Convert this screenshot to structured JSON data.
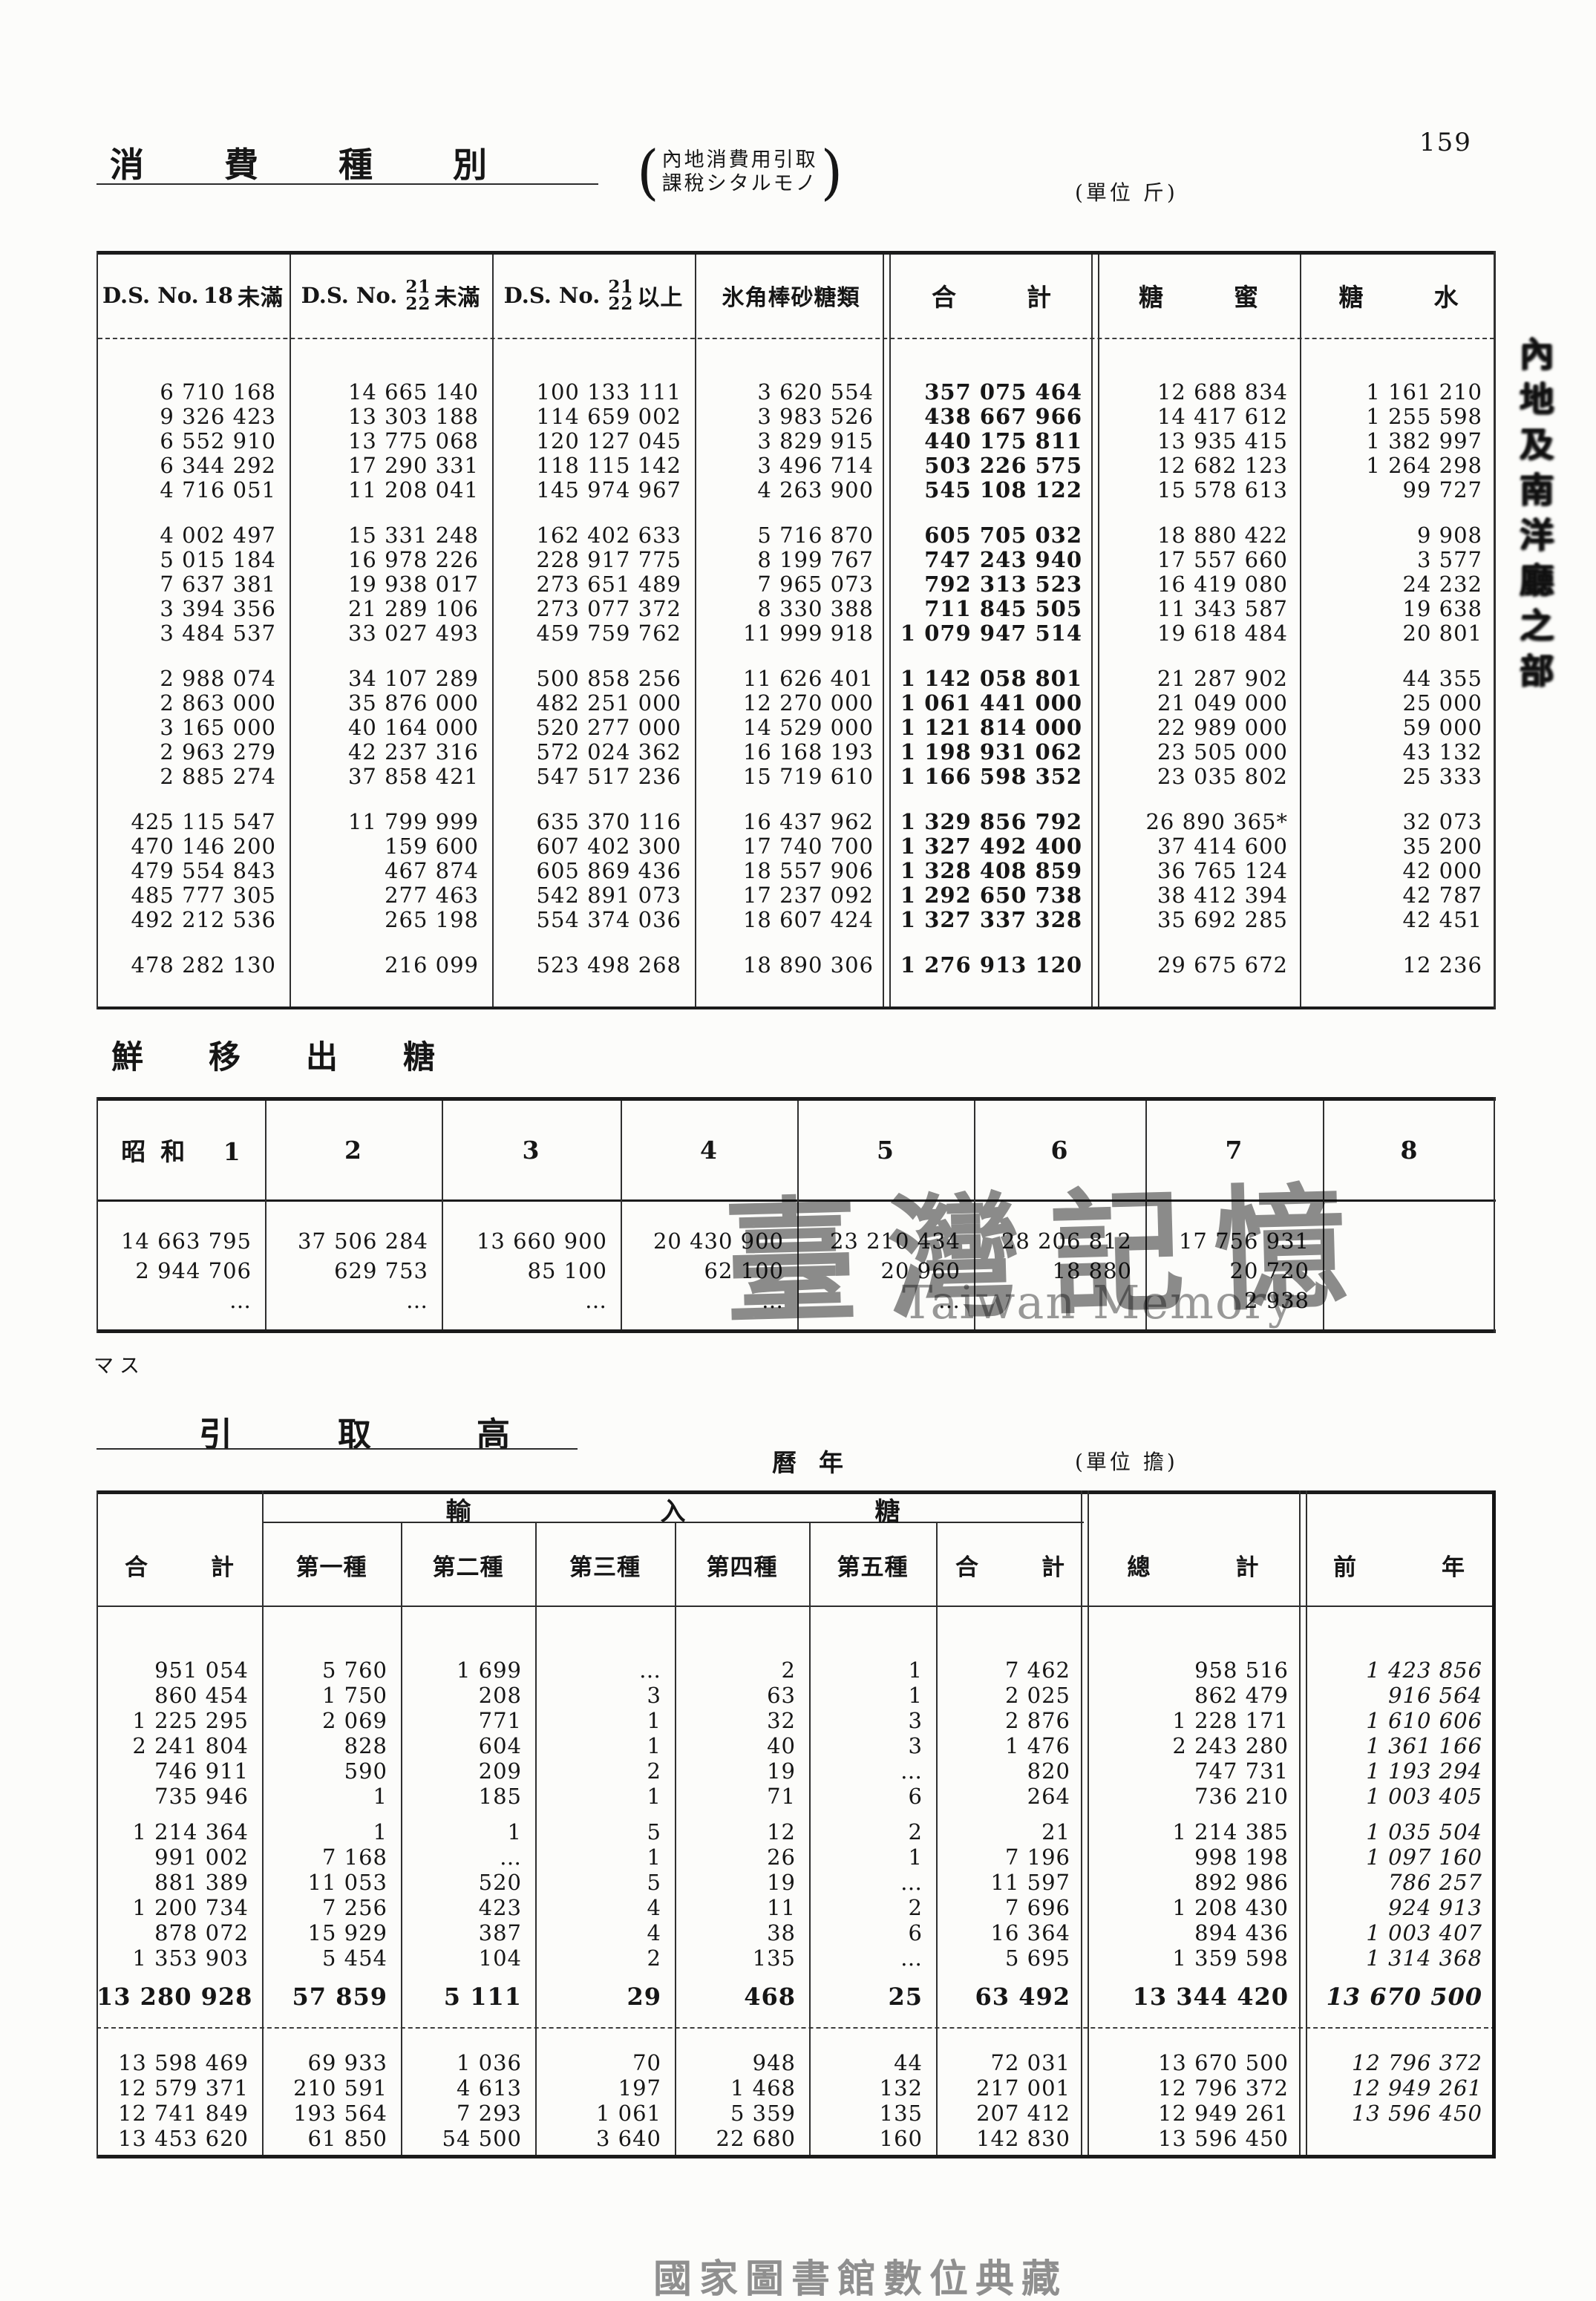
{
  "page": {
    "number": "159",
    "footer": "國家圖書館數位典藏",
    "margin_note": "マス",
    "side_text": "內地及南洋廳之部"
  },
  "watermark": {
    "cjk": "臺灣記憶",
    "latin": "Taiwan Memory"
  },
  "header": {
    "title": "消費種別",
    "annotation_line1": "內地消費用引取",
    "annotation_line2": "課稅シタルモノ",
    "paren_open": "(",
    "paren_close": ")",
    "unit": "(單位 斤)"
  },
  "consumption_table": {
    "headers": {
      "h1": {
        "prefix": "D.S. No.",
        "value": "18",
        "suffix": "未滿"
      },
      "h2": {
        "prefix": "D.S. No.",
        "num": "21",
        "den": "22",
        "suffix": "未滿"
      },
      "h3": {
        "prefix": "D.S. No.",
        "num": "21",
        "den": "22",
        "suffix": "以上"
      },
      "h4": "氷角棒砂糖類",
      "h5": "合計",
      "h6": "糖蜜",
      "h7": "糖水"
    },
    "groups": [
      [
        [
          "6 710 168",
          "14 665 140",
          "100 133 111",
          "3 620 554",
          "357 075 464",
          "12 688 834",
          "1 161 210"
        ],
        [
          "9 326 423",
          "13 303 188",
          "114 659 002",
          "3 983 526",
          "438 667 966",
          "14 417 612",
          "1 255 598"
        ],
        [
          "6 552 910",
          "13 775 068",
          "120 127 045",
          "3 829 915",
          "440 175 811",
          "13 935 415",
          "1 382 997"
        ],
        [
          "6 344 292",
          "17 290 331",
          "118 115 142",
          "3 496 714",
          "503 226 575",
          "12 682 123",
          "1 264 298"
        ],
        [
          "4 716 051",
          "11 208 041",
          "145 974 967",
          "4 263 900",
          "545 108 122",
          "15 578 613",
          "99 727"
        ]
      ],
      [
        [
          "4 002 497",
          "15 331 248",
          "162 402 633",
          "5 716 870",
          "605 705 032",
          "18 880 422",
          "9 908"
        ],
        [
          "5 015 184",
          "16 978 226",
          "228 917 775",
          "8 199 767",
          "747 243 940",
          "17 557 660",
          "3 577"
        ],
        [
          "7 637 381",
          "19 938 017",
          "273 651 489",
          "7 965 073",
          "792 313 523",
          "16 419 080",
          "24 232"
        ],
        [
          "3 394 356",
          "21 289 106",
          "273 077 372",
          "8 330 388",
          "711 845 505",
          "11 343 587",
          "19 638"
        ],
        [
          "3 484 537",
          "33 027 493",
          "459 759 762",
          "11 999 918",
          "1 079 947 514",
          "19 618 484",
          "20 801"
        ]
      ],
      [
        [
          "2 988 074",
          "34 107 289",
          "500 858 256",
          "11 626 401",
          "1 142 058 801",
          "21 287 902",
          "44 355"
        ],
        [
          "2 863 000",
          "35 876 000",
          "482 251 000",
          "12 270 000",
          "1 061 441 000",
          "21 049 000",
          "25 000"
        ],
        [
          "3 165 000",
          "40 164 000",
          "520 277 000",
          "14 529 000",
          "1 121 814 000",
          "22 989 000",
          "59 000"
        ],
        [
          "2 963 279",
          "42 237 316",
          "572 024 362",
          "16 168 193",
          "1 198 931 062",
          "23 505 000",
          "43 132"
        ],
        [
          "2 885 274",
          "37 858 421",
          "547 517 236",
          "15 719 610",
          "1 166 598 352",
          "23 035 802",
          "25 333"
        ]
      ],
      [
        [
          "425 115 547",
          "11 799 999",
          "635 370 116",
          "16 437 962",
          "1 329 856 792",
          "26 890 365*",
          "32 073"
        ],
        [
          "470 146 200",
          "159 600",
          "607 402 300",
          "17 740 700",
          "1 327 492 400",
          "37 414 600",
          "35 200"
        ],
        [
          "479 554 843",
          "467 874",
          "605 869 436",
          "18 557 906",
          "1 328 408 859",
          "36 765 124",
          "42 000"
        ],
        [
          "485 777 305",
          "277 463",
          "542 891 073",
          "17 237 092",
          "1 292 650 738",
          "38 412 394",
          "42 787"
        ],
        [
          "492 212 536",
          "265 198",
          "554 374 036",
          "18 607 424",
          "1 327 337 328",
          "35 692 285",
          "42 451"
        ]
      ],
      [
        [
          "478 282 130",
          "216 099",
          "523 498 268",
          "18 890 306",
          "1 276 913 120",
          "29 675 672",
          "12 236"
        ]
      ]
    ]
  },
  "export_section": {
    "title": "鮮移出糖",
    "headers": [
      "昭和 1",
      "2",
      "3",
      "4",
      "5",
      "6",
      "7",
      "8"
    ],
    "groups": [
      [
        [
          "14 663 795",
          "37 506 284",
          "13 660 900",
          "20 430 900",
          "23 210 434",
          "28 206 812",
          "17 756 931",
          ""
        ],
        [
          "2 944 706",
          "629 753",
          "85 100",
          "62 100",
          "20 960",
          "18 880",
          "20 720",
          ""
        ],
        [
          "…",
          "…",
          "…",
          "…",
          "…",
          "",
          "2 938",
          ""
        ]
      ]
    ]
  },
  "intake_section": {
    "title": "引取高",
    "calendar_label": "曆年",
    "unit": "(單位 擔)",
    "span_header": "輸入糖",
    "columns": [
      "合計",
      "第一種",
      "第二種",
      "第三種",
      "第四種",
      "第五種",
      "合計",
      "總計",
      "前年"
    ],
    "groups": [
      [
        [
          "951 054",
          "5 760",
          "1 699",
          "…",
          "2",
          "1",
          "7 462",
          "958 516",
          "1 423 856"
        ],
        [
          "860 454",
          "1 750",
          "208",
          "3",
          "63",
          "1",
          "2 025",
          "862 479",
          "916 564"
        ],
        [
          "1 225 295",
          "2 069",
          "771",
          "1",
          "32",
          "3",
          "2 876",
          "1 228 171",
          "1 610 606"
        ],
        [
          "2 241 804",
          "828",
          "604",
          "1",
          "40",
          "3",
          "1 476",
          "2 243 280",
          "1 361 166"
        ],
        [
          "746 911",
          "590",
          "209",
          "2",
          "19",
          "…",
          "820",
          "747 731",
          "1 193 294"
        ],
        [
          "735 946",
          "1",
          "185",
          "1",
          "71",
          "6",
          "264",
          "736 210",
          "1 003 405"
        ]
      ],
      [
        [
          "1 214 364",
          "1",
          "1",
          "5",
          "12",
          "2",
          "21",
          "1 214 385",
          "1 035 504"
        ],
        [
          "991 002",
          "7 168",
          "…",
          "1",
          "26",
          "1",
          "7 196",
          "998 198",
          "1 097 160"
        ],
        [
          "881 389",
          "11 053",
          "520",
          "5",
          "19",
          "…",
          "11 597",
          "892 986",
          "786 257"
        ],
        [
          "1 200 734",
          "7 256",
          "423",
          "4",
          "11",
          "2",
          "7 696",
          "1 208 430",
          "924 913"
        ],
        [
          "878 072",
          "15 929",
          "387",
          "4",
          "38",
          "6",
          "16 364",
          "894 436",
          "1 003 407"
        ],
        [
          "1 353 903",
          "5 454",
          "104",
          "2",
          "135",
          "…",
          "5 695",
          "1 359 598",
          "1 314 368"
        ]
      ]
    ],
    "totals": [
      [
        [
          "13 280 928",
          "57 859",
          "5 111",
          "29",
          "468",
          "25",
          "63 492",
          "13 344 420",
          "13 670 500"
        ]
      ]
    ],
    "final": [
      [
        [
          "13 598 469",
          "69 933",
          "1 036",
          "70",
          "948",
          "44",
          "72 031",
          "13 670 500",
          "12 796 372"
        ],
        [
          "12 579 371",
          "210 591",
          "4 613",
          "197",
          "1 468",
          "132",
          "217 001",
          "12 796 372",
          "12 949 261"
        ],
        [
          "12 741 849",
          "193 564",
          "7 293",
          "1 061",
          "5 359",
          "135",
          "207 412",
          "12 949 261",
          "13 596 450"
        ],
        [
          "13 453 620",
          "61 850",
          "54 500",
          "3 640",
          "22 680",
          "160",
          "142 830",
          "13 596 450",
          ""
        ]
      ]
    ]
  }
}
